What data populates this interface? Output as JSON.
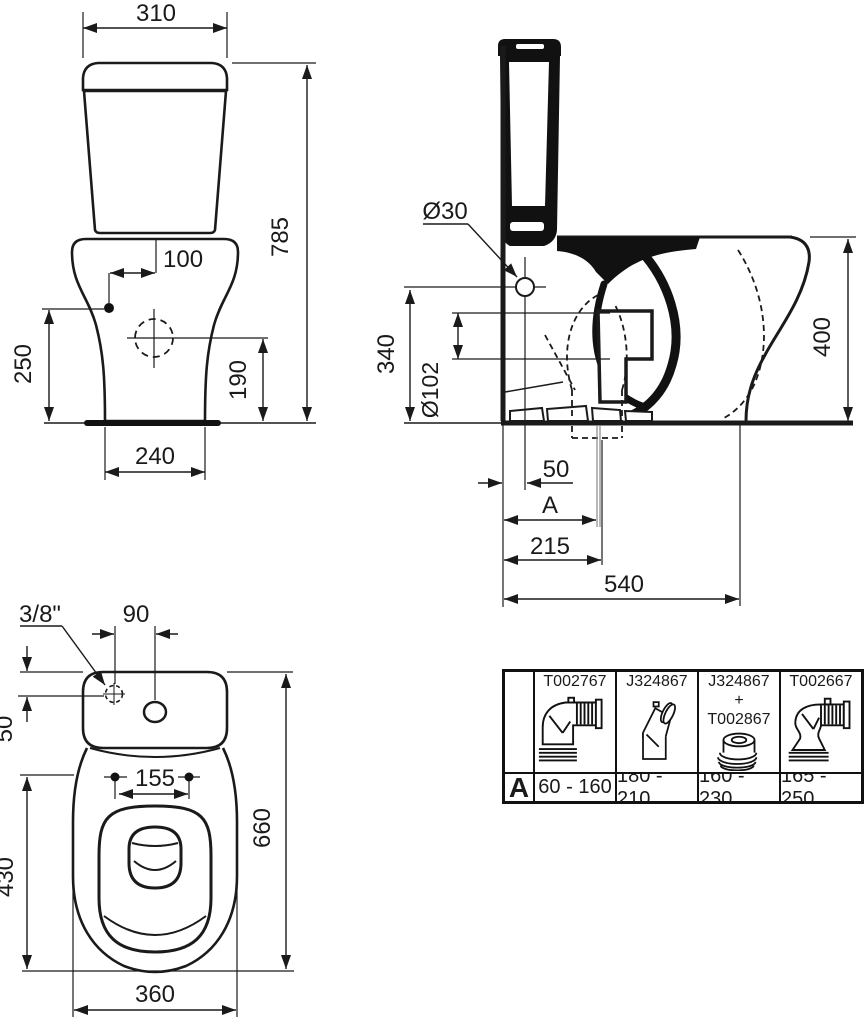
{
  "front_view": {
    "dims": {
      "tank_width": "310",
      "total_height": "785",
      "inlet_offset_x": "100",
      "inlet_height": "250",
      "fixing_height": "190",
      "base_width": "240"
    }
  },
  "side_view": {
    "dims": {
      "inlet_hole_dia": "Ø30",
      "inlet_hole_height": "340",
      "outlet_dia": "Ø102",
      "rim_height": "400",
      "inlet_offset": "50",
      "outlet_var": "A",
      "outlet_distance": "215",
      "total_depth": "540"
    }
  },
  "plan_view": {
    "dims": {
      "supply_thread": "3/8\"",
      "inlet_spacing": "90",
      "supply_offset": "50",
      "seat_hole_spacing": "155",
      "bowl_length": "430",
      "total_length": "660",
      "bowl_width": "360"
    }
  },
  "connector_table": {
    "row_label": "A",
    "columns": [
      {
        "part1": "T002767",
        "range": "60 - 160",
        "icon": "elbow-pipe"
      },
      {
        "part1": "J324867",
        "range": "180 - 210",
        "icon": "angled-adapter"
      },
      {
        "part1": "J324867",
        "part2": "+",
        "part3": "T002867",
        "range": "160 - 230",
        "icon": "offset-ring"
      },
      {
        "part1": "T002667",
        "range": "165 - 250",
        "icon": "s-bend-pipe"
      }
    ]
  }
}
